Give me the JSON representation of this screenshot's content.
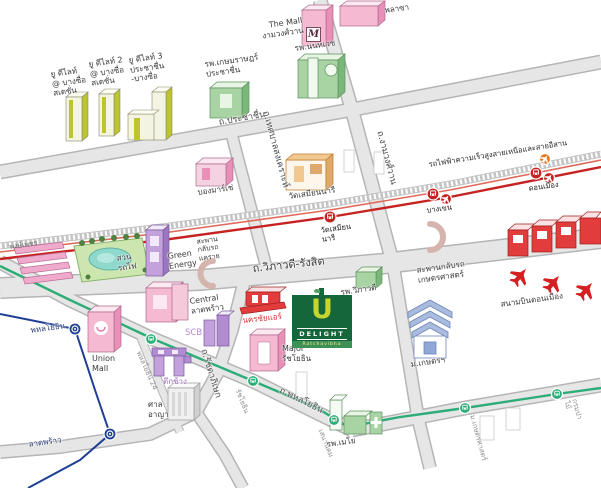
{
  "colors": {
    "red_line": "#c62222",
    "red_line_light": "#e06a5a",
    "green_line": "#2ead78",
    "blue_line": "#1e3f94",
    "road_fill": "#e6e6e6",
    "udelight_green": "#15663b",
    "udelight_yellow": "#c6d62c",
    "pink_building": "#f5b9d2",
    "green_building": "#a8d4a4",
    "purple_building": "#c2a1dc",
    "red_building": "#e23c3c",
    "blue_building": "#a9bbdf"
  },
  "logo": {
    "u": "U",
    "name": "DELIGHT",
    "sub": "Ratchavibha"
  },
  "mall_logo": "M",
  "labels": {
    "u_delight_1": "ยู ดีไลท์\n@ บางซื่อ\nสเตชั่น",
    "u_delight_2": "ยู ดีไลท์ 2\n@ บางซื่อ\nสเตชั่น",
    "u_delight_3": "ยู ดีไลท์ 3\nประชาชื่น\n-บางซื่อ",
    "kasemrad_hospital": "รพ.เกษมราษฎร์\nประชาชื่น",
    "the_mall": "The Mall\nงามวงศ์วาน",
    "plaza": "พลาซา",
    "nonthavej_hospital": "รพ.นนทเวช",
    "prachachuen_road": "ถ.ประชาชื่น",
    "ngamwongwan_road": "ถ.งามวงศ์วาน",
    "thetsaban_road": "ถ.เทศบาลสงเคราะห์",
    "bon_marche": "บองมาร์เช่",
    "wat_samian_nari": "วัดเสมียนนารี",
    "rail_line": "รถไฟฟ้าความเร็วสูงสายเหนือและสายอีสาน",
    "station_wat_samian": "วัดเสมียน\nนารี",
    "station_bang_khen": "บางเขน",
    "station_don_mueang": "ดอนเมือง",
    "phongphet_market": "พงษ์เพชร",
    "suan_rotfai": "สวน\nรถไฟ",
    "green_energy": "Green\nEnergy",
    "khae_rai_bridge": "สะพาน\nกลับรถ\nแคราย",
    "vibhavadi_road": "ถ.วิภาวดี-รังสิต",
    "kaset_bridge": "สะพานกลับรถ\nเกษตรศาสตร์",
    "don_mueang_airport": "สนามบินดอนเมือง",
    "kasetsart_university": "ม.เกษตรฯ",
    "central_ladprao": "Central\nลาดพร้าว",
    "scb": "SCB",
    "union_mall": "Union\nMall",
    "tuk_chang": "ตึกช้าง",
    "criminal_court": "ศาล\nอาญา",
    "major_ratchayothin": "Major\nรัชโยธิน",
    "nakhonchai_air": "นครชัยแอร์",
    "vibhavadi_hospital": "รพ.วิภาวดี",
    "mayo_hospital": "รพ.เมโย",
    "mrt_phahonyothin": "พหลโยธิน",
    "mrt_lat_phrao": "ลาดพร้าว",
    "ratchadaphisek_road": "ถ.รัชดาภิเษก",
    "phahonyothin_road": "ถ.พหลโยธิน",
    "bts_phahonyothin24": "พหลโยธิน 24",
    "bts_ratchayothin": "รัชโยธิน",
    "bts_sena_nikhom": "เสนานิคม",
    "bts_kasetsart": "ม.เกษตรศาสตร์",
    "bts_forest_dept": "กรมป่าไม้"
  }
}
